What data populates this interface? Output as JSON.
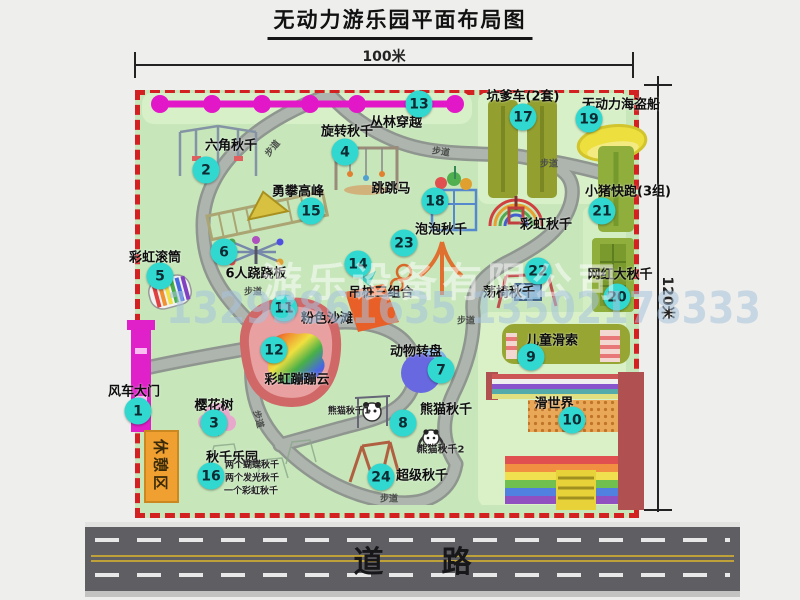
{
  "title": "无动力游乐园平面布局图",
  "dimensions": {
    "width": "100米",
    "height": "120米"
  },
  "road_label": "道路",
  "path_label": "步道",
  "rest_area_label": "休憩区",
  "rainbow_swing_label": "彩虹秋千",
  "panda_swing_1": "熊猫秋千1",
  "panda_swing_2": "熊猫秋千2",
  "swing_park_notes": [
    "两个蝴蝶秋千",
    "两个发光秋千",
    "一个彩虹秋千"
  ],
  "watermark": {
    "company": "游乐设备有限公司",
    "phone": "13293861635 13502178333"
  },
  "colors": {
    "badge": "#30d8cf",
    "map_green": "#c7e7bb",
    "border_red": "#d32020",
    "zipline_magenta": "#e218c8",
    "road_gray": "#5e5e63",
    "rest_orange": "#f0a030"
  },
  "attractions": [
    {
      "num": "1",
      "name": "风车大门"
    },
    {
      "num": "2",
      "name": "六角秋千"
    },
    {
      "num": "3",
      "name": "樱花树"
    },
    {
      "num": "4",
      "name": "旋转秋千"
    },
    {
      "num": "5",
      "name": "彩虹滚筒"
    },
    {
      "num": "6",
      "name": "6人跷跷板"
    },
    {
      "num": "7",
      "name": "动物转盘"
    },
    {
      "num": "8",
      "name": "熊猫秋千"
    },
    {
      "num": "9",
      "name": "儿童滑索"
    },
    {
      "num": "10",
      "name": "滑世界"
    },
    {
      "num": "11",
      "name": "粉色沙滩"
    },
    {
      "num": "12",
      "name": "彩虹蹦蹦云"
    },
    {
      "num": "13",
      "name": "丛林穿越"
    },
    {
      "num": "14",
      "name": "吊桩三组合"
    },
    {
      "num": "15",
      "name": "勇攀高峰"
    },
    {
      "num": "16",
      "name": "秋千乐园"
    },
    {
      "num": "17",
      "name": "坑爹车(2套)"
    },
    {
      "num": "18",
      "name": "跳跳马"
    },
    {
      "num": "19",
      "name": "无动力海盗船"
    },
    {
      "num": "20",
      "name": "网红大秋千"
    },
    {
      "num": "21",
      "name": "小猪快跑(3组)"
    },
    {
      "num": "22",
      "name": "荡椅秋千"
    },
    {
      "num": "23",
      "name": "泡泡秋千"
    },
    {
      "num": "24",
      "name": "超级秋千"
    }
  ]
}
